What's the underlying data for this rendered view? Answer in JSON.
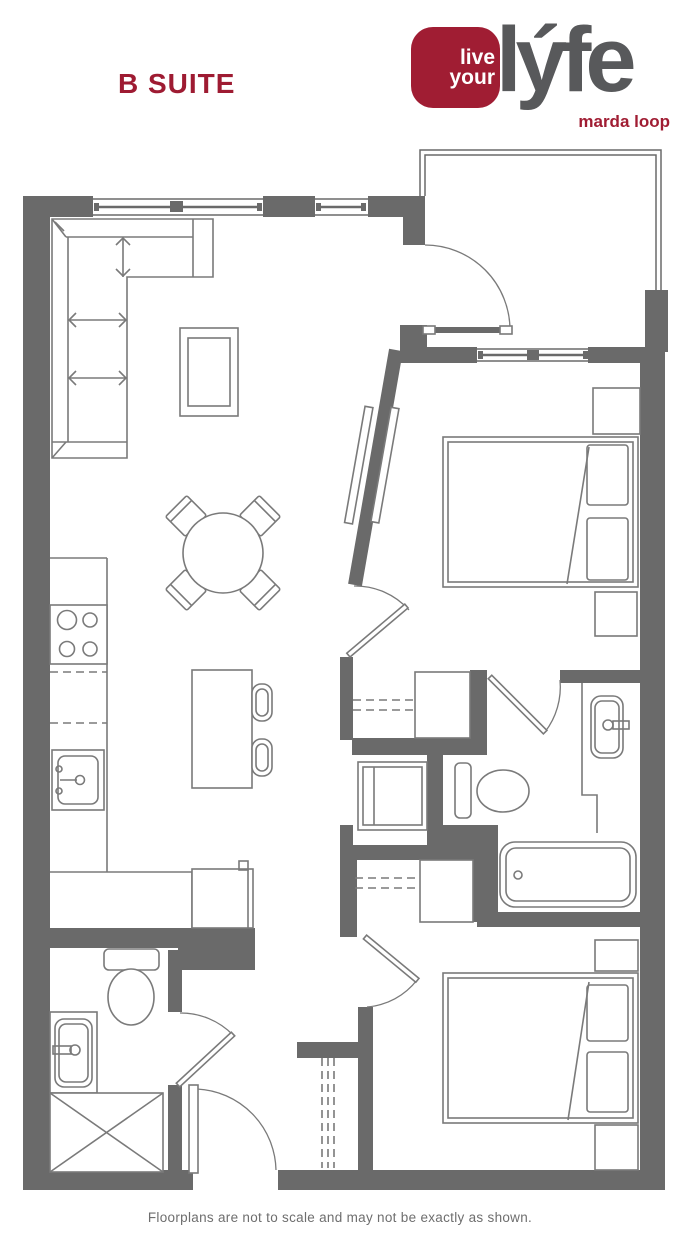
{
  "header": {
    "suite_title": "B SUITE"
  },
  "logo": {
    "badge_line1": "live",
    "badge_line2": "your",
    "wordmark": "lýfe",
    "tagline": "marda loop"
  },
  "footer": {
    "disclaimer": "Floorplans are not to scale and may not be exactly as shown."
  },
  "colors": {
    "accent_red": "#A01D33",
    "title_red": "#9E1B32",
    "logo_gray": "#58595B",
    "wall_gray": "#6A6A6A",
    "fixture_line_gray": "#7A7A7A",
    "footer_text_gray": "#6E6E6E",
    "background": "#FFFFFF"
  },
  "floorplan": {
    "kind": "apartment-suite-floorplan",
    "fixtures": [
      "sectional-sofa",
      "coffee-table",
      "round-dining-table",
      "dining-chairs",
      "kitchen-counter",
      "stove-burners",
      "kitchen-sink",
      "island-with-stools",
      "queen-bed-1",
      "queen-bed-2",
      "nightstands",
      "closet-rods",
      "washer-dryer",
      "toilet",
      "vanity-sink",
      "bathtub",
      "shower",
      "entry-door",
      "swing-doors",
      "sliding-door",
      "balcony-railing",
      "windows"
    ]
  }
}
